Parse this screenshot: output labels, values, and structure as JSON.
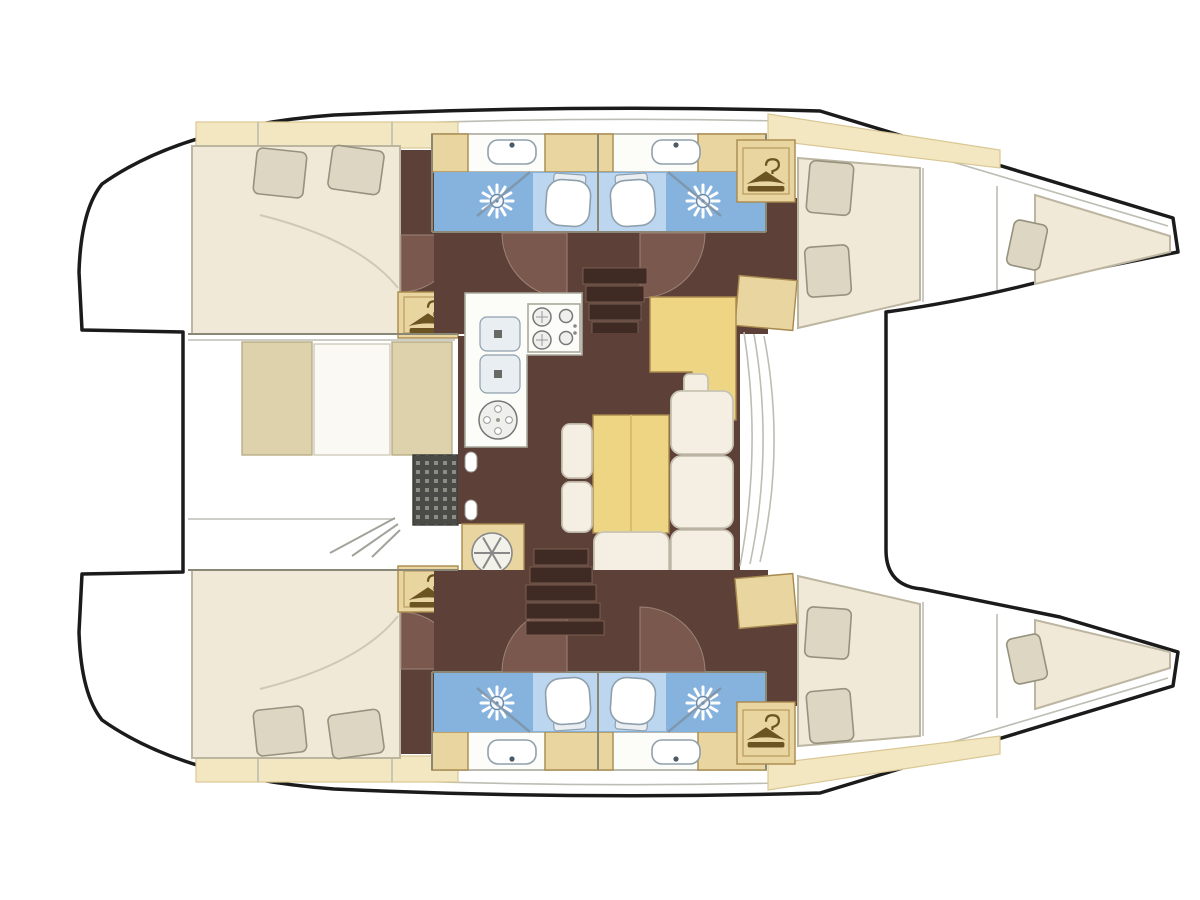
{
  "colors": {
    "outline": "#1b1b1b",
    "thin": "#bdbdb4",
    "wall": "#8a8776",
    "wood": "#e9d5a0",
    "woodBright": "#eed584",
    "woodEdge": "#a8894e",
    "pale2": "#f3e7c2",
    "paleEdge2": "#d9c794",
    "floor": "#5d4038",
    "floorDoor": "#7b584e",
    "tread": "#3f2a24",
    "cream": "#f0e9d8",
    "creamEdge": "#bcb5a0",
    "pillow": "#ddd6c3",
    "pillowEdge": "#96927f",
    "blue": "#86b2de",
    "blueLight": "#bcd6f0",
    "glass": "#7f93a5",
    "counter": "#fcfcf9",
    "cushion": "#f4efe2",
    "bench": "#ddd2ac",
    "grateBg": "#4a4a46",
    "grateDot": "#8d8d85",
    "hanger": "#6b5322"
  },
  "diagram": {
    "type": "floor-plan",
    "subject": "Catamaran interior layout, top-down floor plan, bows to the right",
    "orientation": {
      "bow": "right",
      "stern": "left"
    },
    "port_hull": {
      "aft_cabin": {
        "bed": "double",
        "pillows": 2,
        "wardrobe_hanger_icons": 1,
        "door_arcs": 1
      },
      "aft_head": {
        "toilet": true,
        "shower_sunburst": true,
        "sink": true,
        "glass_partition": true,
        "door_arcs": 1
      },
      "forward_head": {
        "toilet": true,
        "shower_sunburst": true,
        "sink": true,
        "glass_partition": true,
        "door_arcs": 1
      },
      "forward_berth": {
        "bed": "double",
        "pillows": 2,
        "wardrobe_hanger_icons": 1
      },
      "bow_berth": {
        "bed": "single",
        "pillows": 1
      },
      "companionway_treads": 5
    },
    "starboard_hull": {
      "aft_cabin": {
        "bed": "double",
        "pillows": 2,
        "wardrobe_hanger_icons": 1,
        "door_arcs": 1
      },
      "aft_head": {
        "toilet": true,
        "shower_sunburst": true,
        "sink": true,
        "glass_partition": true,
        "door_arcs": 1
      },
      "forward_head": {
        "toilet": true,
        "shower_sunburst": true,
        "sink": true,
        "glass_partition": true,
        "door_arcs": 1
      },
      "forward_berth": {
        "bed": "double",
        "pillows": 2,
        "wardrobe_hanger_icons": 1
      },
      "bow_berth": {
        "bed": "single",
        "pillows": 1
      },
      "companionway_treads": 5
    },
    "bridge_deck": {
      "galley": {
        "shape": "L",
        "stove_burners": 4,
        "sinks": 2,
        "round_hob": 1
      },
      "dinette": {
        "table": 1,
        "sofa_cushions": 4,
        "stools": 2
      },
      "nav_station": {
        "desk": 1,
        "seat": 1
      },
      "cabinet_with_round_fan": 1,
      "cockpit": {
        "bench_cushions": 2,
        "center_panel": 1,
        "floor_grating": 1,
        "door_knobs": 2,
        "step_lines": 3
      },
      "windshield_mullions": 3
    },
    "transoms": {
      "step_curves_per_side": 3
    }
  }
}
